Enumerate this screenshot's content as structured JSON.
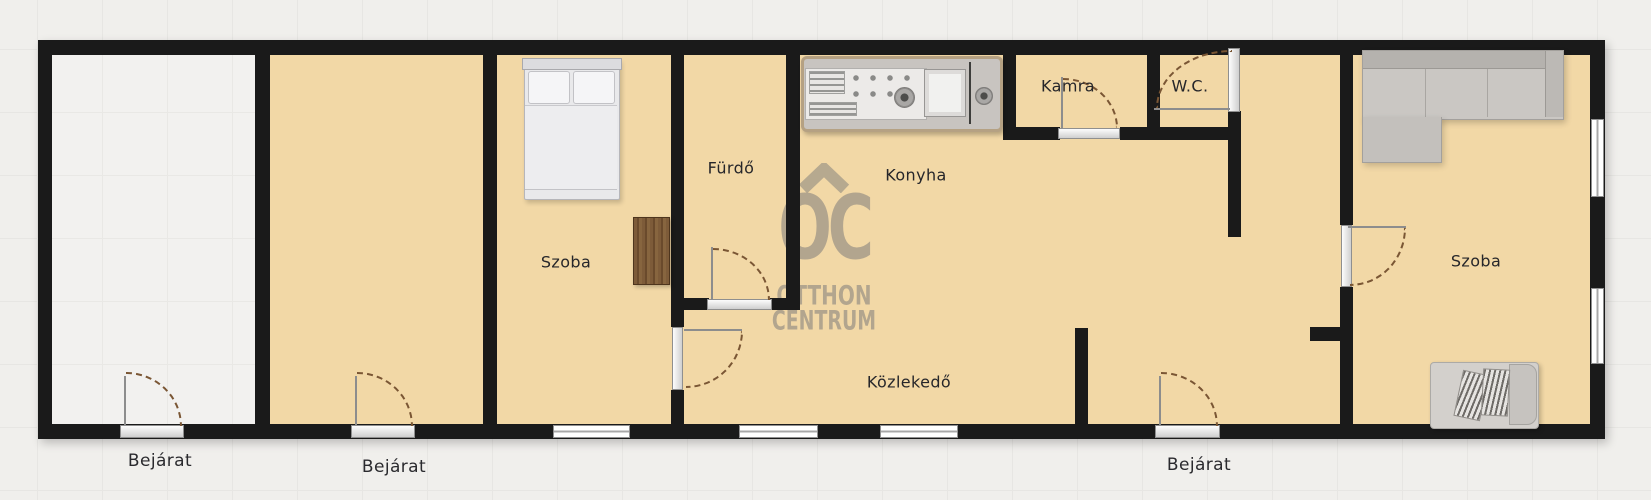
{
  "watermark": {
    "monogram": "OC",
    "line1": "OTTHON",
    "line2": "CENTRUM"
  },
  "rooms": {
    "szoba_left": "Szoba",
    "furdo": "Fürdő",
    "konyha": "Konyha",
    "kamra": "Kamra",
    "wc": "W.C.",
    "kozlekedo": "Közlekedő",
    "szoba_right": "Szoba"
  },
  "entrances": {
    "left": "Bejárat",
    "middle": "Bejárat",
    "right": "Bejárat"
  },
  "furniture": {
    "bed": "double-bed",
    "wardrobe": "wardrobe",
    "kitchen_counter": "kitchen-counter",
    "sofa": "corner-sofa",
    "armchair": "armchair"
  },
  "colors": {
    "floor_tan": "#f2d8a6",
    "floor_unfinished": "#f2f1ef",
    "wall": "#1a1a1a",
    "background": "#f0efec",
    "watermark": "#a89d8a",
    "door_arc": "#7a5634",
    "furniture_gray": "#c9c6c2",
    "wardrobe_wood": "#7b5a38"
  }
}
